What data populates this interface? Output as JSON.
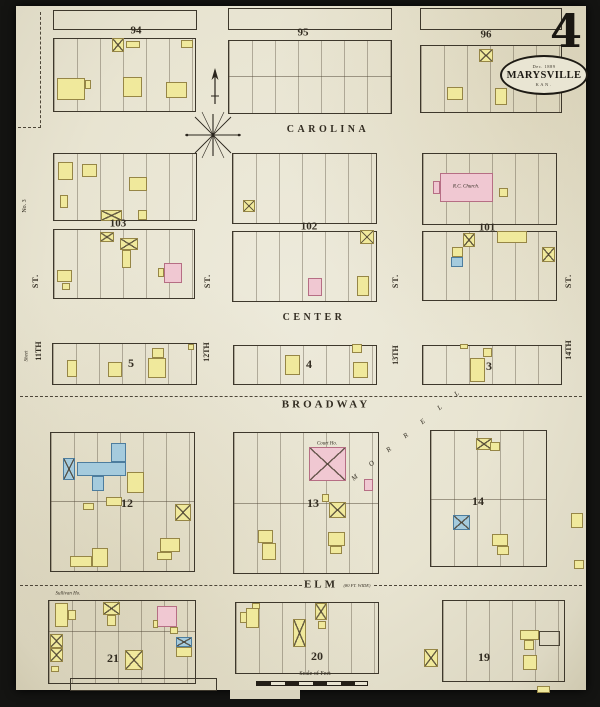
{
  "sheet": {
    "number": "4",
    "title": "MARYSVILLE",
    "date": "Dec. 1889",
    "state": "KAN."
  },
  "colors": {
    "paper": "#e8e4d1",
    "ink": "#332d22",
    "line": "#3e382c",
    "yellow": "#f0e99c",
    "yellowline": "#968646",
    "pink": "#f0c8d2",
    "pinkline": "#b66e84",
    "blue": "#a5cbdd",
    "blueline": "#4d7d9e"
  },
  "blocks": [
    {
      "x": 53,
      "y": 10,
      "w": 142,
      "h": 18,
      "lots": ""
    },
    {
      "x": 228,
      "y": 8,
      "w": 162,
      "h": 20,
      "lots": ""
    },
    {
      "x": 420,
      "y": 8,
      "w": 140,
      "h": 20,
      "lots": ""
    },
    {
      "x": 53,
      "y": 38,
      "w": 141,
      "h": 72,
      "lots": "v"
    },
    {
      "x": 228,
      "y": 40,
      "w": 162,
      "h": 72,
      "lots": "v",
      "mid": 35
    },
    {
      "x": 420,
      "y": 45,
      "w": 140,
      "h": 66,
      "lots": "v"
    },
    {
      "x": 53,
      "y": 153,
      "w": 142,
      "h": 66,
      "lots": "v"
    },
    {
      "x": 53,
      "y": 229,
      "w": 140,
      "h": 68,
      "lots": "v"
    },
    {
      "x": 232,
      "y": 153,
      "w": 143,
      "h": 69,
      "lots": "v"
    },
    {
      "x": 232,
      "y": 231,
      "w": 143,
      "h": 69,
      "lots": "v"
    },
    {
      "x": 422,
      "y": 153,
      "w": 133,
      "h": 70,
      "lots": "v"
    },
    {
      "x": 422,
      "y": 231,
      "w": 133,
      "h": 68,
      "lots": "v"
    },
    {
      "x": 52,
      "y": 343,
      "w": 143,
      "h": 40,
      "lots": "v"
    },
    {
      "x": 233,
      "y": 345,
      "w": 142,
      "h": 38,
      "lots": "v"
    },
    {
      "x": 422,
      "y": 345,
      "w": 138,
      "h": 38,
      "lots": "v"
    },
    {
      "x": 50,
      "y": 432,
      "w": 143,
      "h": 138,
      "lots": "v",
      "mid": 68
    },
    {
      "x": 233,
      "y": 432,
      "w": 144,
      "h": 140,
      "lots": "v",
      "mid": 70
    },
    {
      "x": 430,
      "y": 430,
      "w": 115,
      "h": 135,
      "lots": "v",
      "mid": 68
    },
    {
      "x": 48,
      "y": 600,
      "w": 146,
      "h": 82,
      "lots": "v",
      "mid": 30
    },
    {
      "x": 235,
      "y": 602,
      "w": 142,
      "h": 70,
      "lots": "v"
    },
    {
      "x": 442,
      "y": 600,
      "w": 121,
      "h": 80,
      "lots": "v"
    },
    {
      "x": 70,
      "y": 678,
      "w": 145,
      "h": 11,
      "lots": ""
    }
  ],
  "labels": [
    {
      "name": "block-number-94",
      "text": "94",
      "x": 136,
      "y": 31,
      "size": 11,
      "weight": 700
    },
    {
      "name": "block-number-95",
      "text": "95",
      "x": 303,
      "y": 33,
      "size": 11,
      "weight": 700
    },
    {
      "name": "block-number-96",
      "text": "96",
      "x": 486,
      "y": 35,
      "size": 11,
      "weight": 700
    },
    {
      "name": "street-label-carolina",
      "text": "CAROLINA",
      "x": 328,
      "y": 130,
      "size": 10,
      "spacing": 3.5,
      "weight": 700
    },
    {
      "name": "block-number-103",
      "text": "103",
      "x": 118,
      "y": 224,
      "size": 11,
      "weight": 700
    },
    {
      "name": "block-number-102",
      "text": "102",
      "x": 309,
      "y": 227,
      "size": 11,
      "weight": 700
    },
    {
      "name": "block-number-101",
      "text": "101",
      "x": 487,
      "y": 228,
      "size": 11,
      "weight": 700
    },
    {
      "name": "building-label-rc-church",
      "text": "R.C. Church.",
      "x": 466,
      "y": 187,
      "size": 5,
      "italic": true
    },
    {
      "name": "street-label-st-1",
      "text": "ST.",
      "x": 36,
      "y": 281,
      "size": 8,
      "rot": -90,
      "weight": 700,
      "spacing": 1
    },
    {
      "name": "street-label-st-2",
      "text": "ST.",
      "x": 208,
      "y": 281,
      "size": 8,
      "rot": -90,
      "weight": 700,
      "spacing": 1
    },
    {
      "name": "street-label-st-3",
      "text": "ST.",
      "x": 396,
      "y": 281,
      "size": 8,
      "rot": -90,
      "weight": 700,
      "spacing": 1
    },
    {
      "name": "street-label-st-4",
      "text": "ST.",
      "x": 569,
      "y": 281,
      "size": 8,
      "rot": -90,
      "weight": 700,
      "spacing": 1
    },
    {
      "name": "street-label-center",
      "text": "CENTER",
      "x": 314,
      "y": 318,
      "size": 10,
      "spacing": 3.5,
      "weight": 700
    },
    {
      "name": "margin-note-no3",
      "text": "No. 3",
      "x": 25,
      "y": 206,
      "size": 6,
      "rot": -90
    },
    {
      "name": "margin-note-sheet",
      "text": "Sheet",
      "x": 27,
      "y": 356,
      "size": 5,
      "rot": -90,
      "italic": true
    },
    {
      "name": "street-label-11th",
      "text": "11TH",
      "x": 39,
      "y": 351,
      "size": 8,
      "rot": -90,
      "weight": 700
    },
    {
      "name": "block-number-5",
      "text": "5",
      "x": 131,
      "y": 363,
      "size": 12,
      "weight": 700
    },
    {
      "name": "street-label-12th",
      "text": "12TH",
      "x": 207,
      "y": 352,
      "size": 8,
      "rot": -90,
      "weight": 700
    },
    {
      "name": "block-number-4",
      "text": "4",
      "x": 309,
      "y": 364,
      "size": 12,
      "weight": 700
    },
    {
      "name": "street-label-13th",
      "text": "13TH",
      "x": 396,
      "y": 355,
      "size": 8,
      "rot": -90,
      "weight": 700
    },
    {
      "name": "block-number-3",
      "text": "3",
      "x": 489,
      "y": 366,
      "size": 12,
      "weight": 700
    },
    {
      "name": "street-label-14th",
      "text": "14TH",
      "x": 569,
      "y": 350,
      "size": 8,
      "rot": -90,
      "weight": 700
    },
    {
      "name": "street-label-broadway",
      "text": "BROADWAY",
      "x": 326,
      "y": 405,
      "size": 11,
      "spacing": 3,
      "weight": 700
    },
    {
      "name": "building-label-court-house",
      "text": "Court Ho.",
      "x": 327,
      "y": 444,
      "size": 5,
      "italic": true
    },
    {
      "name": "block-number-12",
      "text": "12",
      "x": 127,
      "y": 503,
      "size": 12,
      "weight": 700
    },
    {
      "name": "block-number-13",
      "text": "13",
      "x": 313,
      "y": 503,
      "size": 12,
      "weight": 700
    },
    {
      "name": "block-number-14",
      "text": "14",
      "x": 478,
      "y": 501,
      "size": 12,
      "weight": 700
    },
    {
      "name": "diagonal-street-letter",
      "text": "M",
      "x": 355,
      "y": 478,
      "size": 7,
      "rot": -40,
      "italic": true
    },
    {
      "name": "diagonal-street-letter",
      "text": "O",
      "x": 372,
      "y": 464,
      "size": 7,
      "rot": -40,
      "italic": true
    },
    {
      "name": "diagonal-street-letter",
      "text": "R",
      "x": 389,
      "y": 450,
      "size": 7,
      "rot": -40,
      "italic": true
    },
    {
      "name": "diagonal-street-letter",
      "text": "R",
      "x": 406,
      "y": 436,
      "size": 7,
      "rot": -40,
      "italic": true
    },
    {
      "name": "diagonal-street-letter",
      "text": "E",
      "x": 423,
      "y": 422,
      "size": 7,
      "rot": -40,
      "italic": true
    },
    {
      "name": "diagonal-street-letter",
      "text": "L",
      "x": 440,
      "y": 408,
      "size": 7,
      "rot": -40,
      "italic": true
    },
    {
      "name": "diagonal-street-letter",
      "text": "L",
      "x": 457,
      "y": 394,
      "size": 7,
      "rot": -40,
      "italic": true
    },
    {
      "name": "street-label-elm",
      "text": "ELM",
      "x": 321,
      "y": 585,
      "size": 11,
      "spacing": 3,
      "weight": 700
    },
    {
      "name": "street-note-elm-width",
      "text": "(80 FT. WIDE)",
      "x": 357,
      "y": 586,
      "size": 4.5,
      "italic": true
    },
    {
      "name": "building-label-sullivan-house",
      "text": "Sullivan Ho.",
      "x": 68,
      "y": 594,
      "size": 5,
      "italic": true
    },
    {
      "name": "block-number-21",
      "text": "21",
      "x": 113,
      "y": 658,
      "size": 12,
      "weight": 700
    },
    {
      "name": "block-number-20",
      "text": "20",
      "x": 317,
      "y": 656,
      "size": 12,
      "weight": 700
    },
    {
      "name": "block-number-19",
      "text": "19",
      "x": 484,
      "y": 657,
      "size": 12,
      "weight": 700
    },
    {
      "name": "scale-label",
      "text": "Scale of Feet",
      "x": 315,
      "y": 674,
      "size": 6
    }
  ],
  "buildings": [
    {
      "x": 112,
      "y": 38,
      "w": 12,
      "h": 14,
      "c": "y",
      "cross": true
    },
    {
      "x": 126,
      "y": 41,
      "w": 14,
      "h": 7,
      "c": "y"
    },
    {
      "x": 181,
      "y": 40,
      "w": 12,
      "h": 8,
      "c": "y"
    },
    {
      "x": 57,
      "y": 78,
      "w": 28,
      "h": 22,
      "c": "y"
    },
    {
      "x": 85,
      "y": 80,
      "w": 6,
      "h": 9,
      "c": "y"
    },
    {
      "x": 123,
      "y": 77,
      "w": 19,
      "h": 20,
      "c": "y"
    },
    {
      "x": 166,
      "y": 82,
      "w": 21,
      "h": 16,
      "c": "y"
    },
    {
      "x": 479,
      "y": 49,
      "w": 14,
      "h": 13,
      "c": "y",
      "cross": true
    },
    {
      "x": 447,
      "y": 87,
      "w": 16,
      "h": 13,
      "c": "y"
    },
    {
      "x": 495,
      "y": 88,
      "w": 12,
      "h": 17,
      "c": "y"
    },
    {
      "x": 58,
      "y": 162,
      "w": 15,
      "h": 18,
      "c": "y"
    },
    {
      "x": 82,
      "y": 164,
      "w": 15,
      "h": 13,
      "c": "y"
    },
    {
      "x": 129,
      "y": 177,
      "w": 18,
      "h": 14,
      "c": "y"
    },
    {
      "x": 60,
      "y": 195,
      "w": 8,
      "h": 13,
      "c": "y"
    },
    {
      "x": 101,
      "y": 210,
      "w": 21,
      "h": 11,
      "c": "y",
      "cross": true
    },
    {
      "x": 138,
      "y": 210,
      "w": 9,
      "h": 10,
      "c": "y"
    },
    {
      "x": 100,
      "y": 232,
      "w": 14,
      "h": 10,
      "c": "y",
      "cross": true
    },
    {
      "x": 120,
      "y": 238,
      "w": 18,
      "h": 12,
      "c": "y",
      "cross": true
    },
    {
      "x": 122,
      "y": 250,
      "w": 9,
      "h": 18,
      "c": "y"
    },
    {
      "x": 57,
      "y": 270,
      "w": 15,
      "h": 12,
      "c": "y"
    },
    {
      "x": 62,
      "y": 283,
      "w": 8,
      "h": 7,
      "c": "y"
    },
    {
      "x": 164,
      "y": 263,
      "w": 18,
      "h": 20,
      "c": "p"
    },
    {
      "x": 158,
      "y": 268,
      "w": 6,
      "h": 9,
      "c": "y"
    },
    {
      "x": 243,
      "y": 200,
      "w": 12,
      "h": 12,
      "c": "y",
      "cross": true
    },
    {
      "x": 360,
      "y": 230,
      "w": 14,
      "h": 14,
      "c": "y",
      "cross": true
    },
    {
      "x": 308,
      "y": 278,
      "w": 14,
      "h": 18,
      "c": "p"
    },
    {
      "x": 357,
      "y": 276,
      "w": 12,
      "h": 20,
      "c": "y"
    },
    {
      "x": 440,
      "y": 173,
      "w": 53,
      "h": 29,
      "c": "p"
    },
    {
      "x": 433,
      "y": 181,
      "w": 7,
      "h": 13,
      "c": "p"
    },
    {
      "x": 499,
      "y": 188,
      "w": 9,
      "h": 9,
      "c": "y"
    },
    {
      "x": 463,
      "y": 233,
      "w": 12,
      "h": 14,
      "c": "y",
      "cross": true
    },
    {
      "x": 497,
      "y": 231,
      "w": 30,
      "h": 12,
      "c": "y"
    },
    {
      "x": 452,
      "y": 247,
      "w": 11,
      "h": 10,
      "c": "y"
    },
    {
      "x": 451,
      "y": 257,
      "w": 12,
      "h": 10,
      "c": "b"
    },
    {
      "x": 542,
      "y": 247,
      "w": 13,
      "h": 15,
      "c": "y",
      "cross": true
    },
    {
      "x": 67,
      "y": 360,
      "w": 10,
      "h": 17,
      "c": "y"
    },
    {
      "x": 108,
      "y": 362,
      "w": 14,
      "h": 15,
      "c": "y"
    },
    {
      "x": 152,
      "y": 348,
      "w": 12,
      "h": 10,
      "c": "y"
    },
    {
      "x": 148,
      "y": 358,
      "w": 18,
      "h": 20,
      "c": "y"
    },
    {
      "x": 188,
      "y": 344,
      "w": 6,
      "h": 6,
      "c": "y"
    },
    {
      "x": 285,
      "y": 355,
      "w": 15,
      "h": 20,
      "c": "y"
    },
    {
      "x": 352,
      "y": 344,
      "w": 10,
      "h": 9,
      "c": "y"
    },
    {
      "x": 353,
      "y": 362,
      "w": 15,
      "h": 16,
      "c": "y"
    },
    {
      "x": 460,
      "y": 344,
      "w": 8,
      "h": 5,
      "c": "y"
    },
    {
      "x": 483,
      "y": 348,
      "w": 9,
      "h": 9,
      "c": "y"
    },
    {
      "x": 470,
      "y": 358,
      "w": 15,
      "h": 24,
      "c": "y"
    },
    {
      "x": 63,
      "y": 458,
      "w": 12,
      "h": 22,
      "c": "b",
      "cross": true
    },
    {
      "x": 77,
      "y": 462,
      "w": 49,
      "h": 14,
      "c": "b"
    },
    {
      "x": 111,
      "y": 443,
      "w": 15,
      "h": 19,
      "c": "b"
    },
    {
      "x": 92,
      "y": 476,
      "w": 12,
      "h": 15,
      "c": "b"
    },
    {
      "x": 127,
      "y": 472,
      "w": 17,
      "h": 21,
      "c": "y"
    },
    {
      "x": 83,
      "y": 503,
      "w": 11,
      "h": 7,
      "c": "y"
    },
    {
      "x": 106,
      "y": 497,
      "w": 16,
      "h": 9,
      "c": "y"
    },
    {
      "x": 175,
      "y": 504,
      "w": 16,
      "h": 17,
      "c": "y",
      "cross": true
    },
    {
      "x": 92,
      "y": 548,
      "w": 16,
      "h": 19,
      "c": "y"
    },
    {
      "x": 70,
      "y": 556,
      "w": 22,
      "h": 11,
      "c": "y"
    },
    {
      "x": 160,
      "y": 538,
      "w": 20,
      "h": 14,
      "c": "y"
    },
    {
      "x": 157,
      "y": 552,
      "w": 15,
      "h": 8,
      "c": "y"
    },
    {
      "x": 309,
      "y": 447,
      "w": 37,
      "h": 34,
      "c": "p",
      "cross": true
    },
    {
      "x": 364,
      "y": 479,
      "w": 9,
      "h": 12,
      "c": "p"
    },
    {
      "x": 322,
      "y": 494,
      "w": 7,
      "h": 8,
      "c": "y"
    },
    {
      "x": 329,
      "y": 502,
      "w": 17,
      "h": 16,
      "c": "y",
      "cross": true
    },
    {
      "x": 258,
      "y": 530,
      "w": 15,
      "h": 13,
      "c": "y"
    },
    {
      "x": 262,
      "y": 543,
      "w": 14,
      "h": 17,
      "c": "y"
    },
    {
      "x": 328,
      "y": 532,
      "w": 17,
      "h": 14,
      "c": "y"
    },
    {
      "x": 330,
      "y": 546,
      "w": 12,
      "h": 8,
      "c": "y"
    },
    {
      "x": 476,
      "y": 438,
      "w": 16,
      "h": 12,
      "c": "y",
      "cross": true
    },
    {
      "x": 490,
      "y": 442,
      "w": 10,
      "h": 9,
      "c": "y"
    },
    {
      "x": 453,
      "y": 515,
      "w": 17,
      "h": 15,
      "c": "b",
      "cross": true
    },
    {
      "x": 492,
      "y": 534,
      "w": 16,
      "h": 12,
      "c": "y"
    },
    {
      "x": 497,
      "y": 546,
      "w": 12,
      "h": 9,
      "c": "y"
    },
    {
      "x": 571,
      "y": 513,
      "w": 12,
      "h": 15,
      "c": "y"
    },
    {
      "x": 574,
      "y": 560,
      "w": 10,
      "h": 9,
      "c": "y"
    },
    {
      "x": 55,
      "y": 603,
      "w": 13,
      "h": 24,
      "c": "y"
    },
    {
      "x": 68,
      "y": 610,
      "w": 8,
      "h": 10,
      "c": "y"
    },
    {
      "x": 103,
      "y": 602,
      "w": 17,
      "h": 13,
      "c": "y",
      "cross": true
    },
    {
      "x": 107,
      "y": 615,
      "w": 9,
      "h": 11,
      "c": "y"
    },
    {
      "x": 157,
      "y": 606,
      "w": 20,
      "h": 21,
      "c": "p"
    },
    {
      "x": 153,
      "y": 620,
      "w": 5,
      "h": 8,
      "c": "y"
    },
    {
      "x": 170,
      "y": 627,
      "w": 8,
      "h": 7,
      "c": "y"
    },
    {
      "x": 176,
      "y": 637,
      "w": 16,
      "h": 10,
      "c": "b",
      "cross": true
    },
    {
      "x": 176,
      "y": 647,
      "w": 16,
      "h": 10,
      "c": "y"
    },
    {
      "x": 125,
      "y": 650,
      "w": 18,
      "h": 20,
      "c": "y",
      "cross": true
    },
    {
      "x": 50,
      "y": 634,
      "w": 13,
      "h": 14,
      "c": "y",
      "cross": true
    },
    {
      "x": 50,
      "y": 648,
      "w": 13,
      "h": 14,
      "c": "y",
      "cross": true
    },
    {
      "x": 51,
      "y": 666,
      "w": 8,
      "h": 6,
      "c": "y"
    },
    {
      "x": 246,
      "y": 608,
      "w": 13,
      "h": 20,
      "c": "y"
    },
    {
      "x": 240,
      "y": 612,
      "w": 7,
      "h": 11,
      "c": "y"
    },
    {
      "x": 252,
      "y": 603,
      "w": 8,
      "h": 6,
      "c": "y"
    },
    {
      "x": 293,
      "y": 619,
      "w": 13,
      "h": 28,
      "c": "y",
      "cross": true
    },
    {
      "x": 315,
      "y": 603,
      "w": 12,
      "h": 17,
      "c": "y",
      "cross": true
    },
    {
      "x": 318,
      "y": 621,
      "w": 8,
      "h": 8,
      "c": "y"
    },
    {
      "x": 424,
      "y": 649,
      "w": 14,
      "h": 18,
      "c": "y",
      "cross": true
    },
    {
      "x": 520,
      "y": 630,
      "w": 19,
      "h": 10,
      "c": "y"
    },
    {
      "x": 524,
      "y": 640,
      "w": 10,
      "h": 10,
      "c": "y"
    },
    {
      "x": 539,
      "y": 631,
      "w": 21,
      "h": 15,
      "c": "w"
    },
    {
      "x": 523,
      "y": 655,
      "w": 14,
      "h": 15,
      "c": "y"
    },
    {
      "x": 537,
      "y": 686,
      "w": 13,
      "h": 7,
      "c": "y"
    }
  ],
  "dashes": [
    {
      "x": 40,
      "y": 12,
      "h": 116,
      "v": true
    },
    {
      "x": 18,
      "y": 127,
      "w": 23
    },
    {
      "x": 20,
      "y": 396,
      "w": 562
    },
    {
      "x": 20,
      "y": 585,
      "w": 282
    },
    {
      "x": 374,
      "y": 585,
      "w": 208
    }
  ]
}
